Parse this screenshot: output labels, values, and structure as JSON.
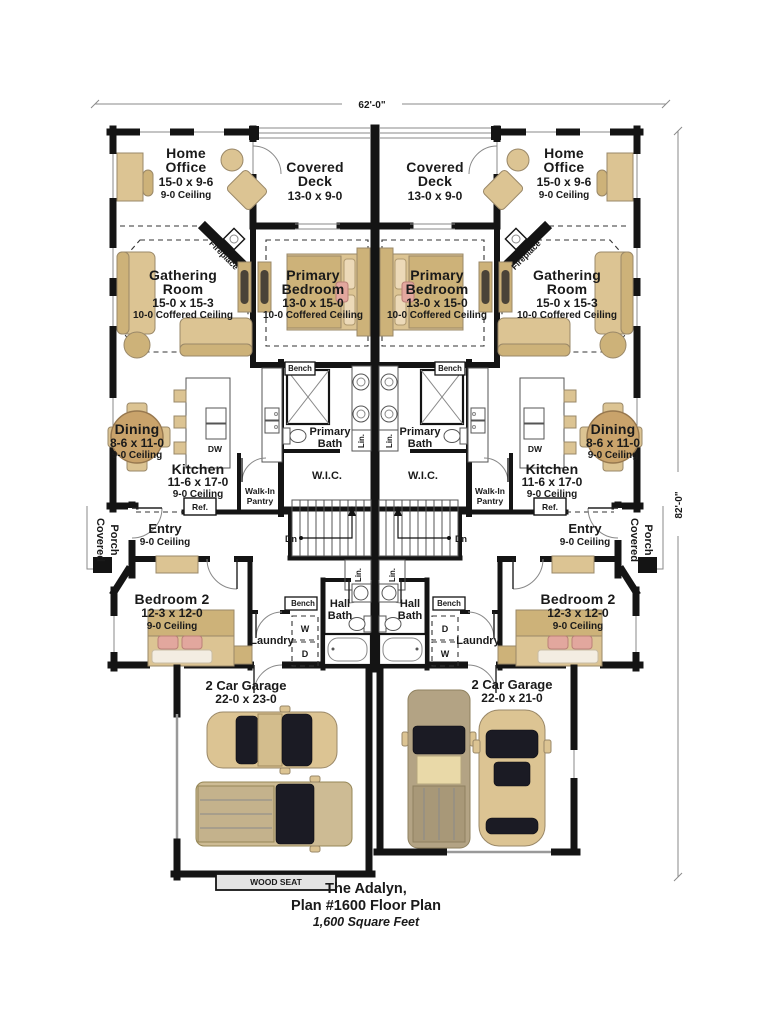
{
  "plan": {
    "title_lines": [
      "The Adalyn,",
      "Plan #1600 Floor Plan",
      "1,600 Square Feet"
    ],
    "width_dim": "62'-0\"",
    "height_dim": "82'-0\""
  },
  "rooms": {
    "home_office": {
      "name_lines": [
        "Home",
        "Office"
      ],
      "dims": "15-0 x 9-6",
      "ceiling": "9-0 Ceiling"
    },
    "covered_deck": {
      "name_lines": [
        "Covered",
        "Deck"
      ],
      "dims": "13-0 x 9-0"
    },
    "gathering_room": {
      "name_lines": [
        "Gathering",
        "Room"
      ],
      "dims": "15-0 x 15-3",
      "ceiling": "10-0 Coffered Ceiling"
    },
    "primary_bedroom": {
      "name_lines": [
        "Primary",
        "Bedroom"
      ],
      "dims": "13-0 x 15-0",
      "ceiling": "10-0 Coffered Ceiling"
    },
    "dining": {
      "name": "Dining",
      "dims": "8-6 x 11-0",
      "ceiling": "9-0 Ceiling"
    },
    "kitchen": {
      "name": "Kitchen",
      "dims": "11-6 x 17-0",
      "ceiling": "9-0 Ceiling"
    },
    "primary_bath": {
      "name_lines": [
        "Primary",
        "Bath"
      ]
    },
    "wic": {
      "name": "W.I.C."
    },
    "walk_in_pantry": {
      "name_lines": [
        "Walk-In",
        "Pantry"
      ]
    },
    "entry": {
      "name": "Entry",
      "ceiling": "9-0 Ceiling"
    },
    "covered_porch": {
      "name_lines": [
        "Covered",
        "Porch"
      ]
    },
    "bedroom_2": {
      "name": "Bedroom 2",
      "dims": "12-3 x 12-0",
      "ceiling": "9-0 Ceiling"
    },
    "hall_bath": {
      "name_lines": [
        "Hall",
        "Bath"
      ]
    },
    "laundry": {
      "name": "Laundry"
    },
    "garage_left": {
      "name": "2 Car Garage",
      "dims": "22-0 x 23-0"
    },
    "garage_right": {
      "name": "2 Car Garage",
      "dims": "22-0 x 21-0"
    }
  },
  "fixtures": {
    "fireplace": "Fireplace",
    "bench": "Bench",
    "linen": "Lin.",
    "refrigerator": "Ref.",
    "dishwasher": "DW",
    "stairs_down": "Dn",
    "washer": "W",
    "dryer": "D",
    "wood_seat": "WOOD SEAT"
  },
  "colors": {
    "wall": "#141414",
    "furniture_tan": "#dcc493",
    "furniture_dark": "#cdb279",
    "table_brown": "#c9a36b",
    "pillow_pink": "#e2a79e",
    "car_glass": "#1b1b24"
  }
}
